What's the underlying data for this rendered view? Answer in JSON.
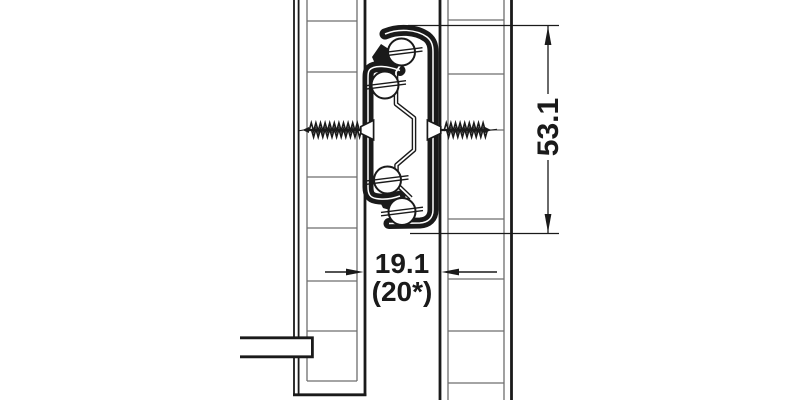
{
  "figure": {
    "type": "technical-drawing",
    "description": "Cross-section of a ball-bearing drawer runner mounted between drawer side panel and cabinet side panel",
    "background_color": "#ffffff",
    "line_color": "#1a1a1a",
    "hatch_color": "#6e6e6e",
    "dimensions": {
      "runner_height": {
        "label": "53.1",
        "orientation": "vertical"
      },
      "installation_space": {
        "label": "19.1",
        "label_alt": "(20*)",
        "orientation": "horizontal"
      }
    }
  }
}
